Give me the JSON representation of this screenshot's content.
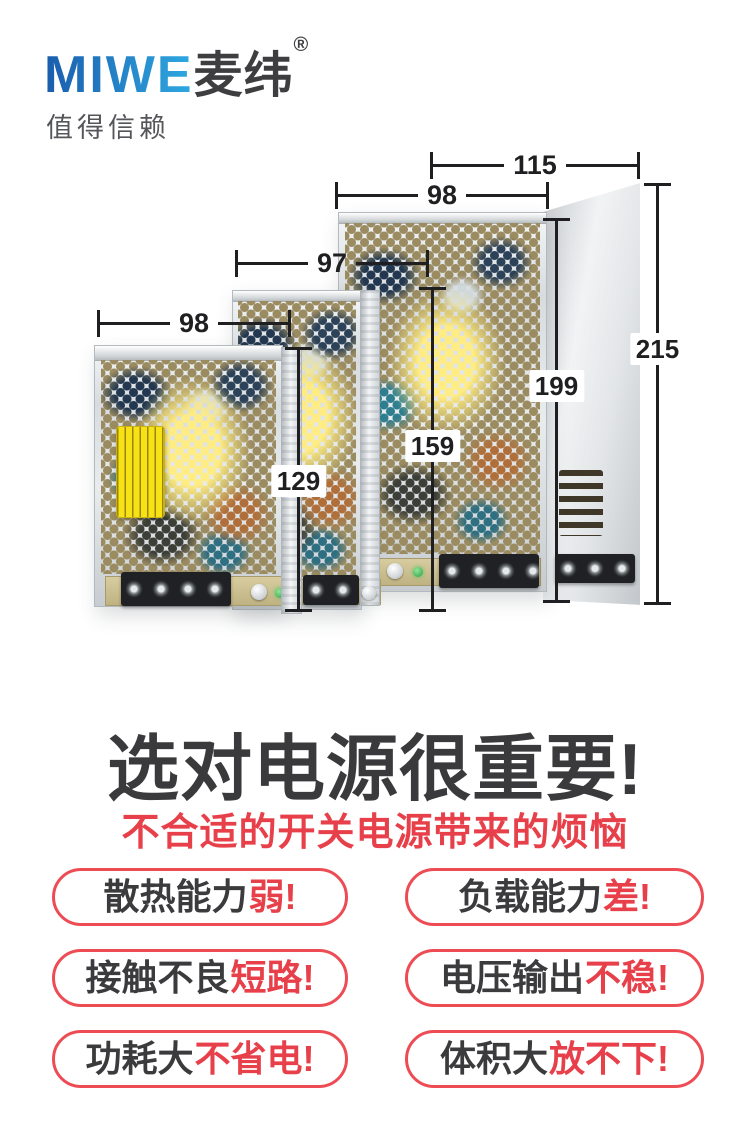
{
  "brand": {
    "logo_latin": "MIWE",
    "logo_cn": "麦纬",
    "registered_mark": "®",
    "tagline": "值得信赖",
    "logo_gradient_start": "#1a5dad",
    "logo_gradient_end": "#2fa9e1",
    "logo_cn_color": "#3e3e40"
  },
  "size_diagram": {
    "dims": {
      "large_depth": "115",
      "large_width": "98",
      "medium_width": "97",
      "small_width": "98",
      "large_total_height": "215",
      "large_height": "199",
      "medium_height": "159",
      "small_height": "129"
    }
  },
  "headline": {
    "title": "选对电源很重要!",
    "subtitle": "不合适的开关电源带来的烦恼",
    "title_color": "#3a3a3c",
    "subtitle_color": "#e7404a"
  },
  "pain_points": [
    {
      "label": "散热能力",
      "highlight": "弱!"
    },
    {
      "label": "负载能力",
      "highlight": "差!"
    },
    {
      "label": "接触不良",
      "highlight": "短路!"
    },
    {
      "label": "电压输出",
      "highlight": "不稳!"
    },
    {
      "label": "功耗大",
      "highlight": "不省电!"
    },
    {
      "label": "体积大",
      "highlight": "放不下!"
    }
  ],
  "colors": {
    "accent_red": "#e7404a",
    "pill_border": "#ee4c55",
    "dim_line": "#1f1f21",
    "tagline_gray": "#55565a"
  }
}
